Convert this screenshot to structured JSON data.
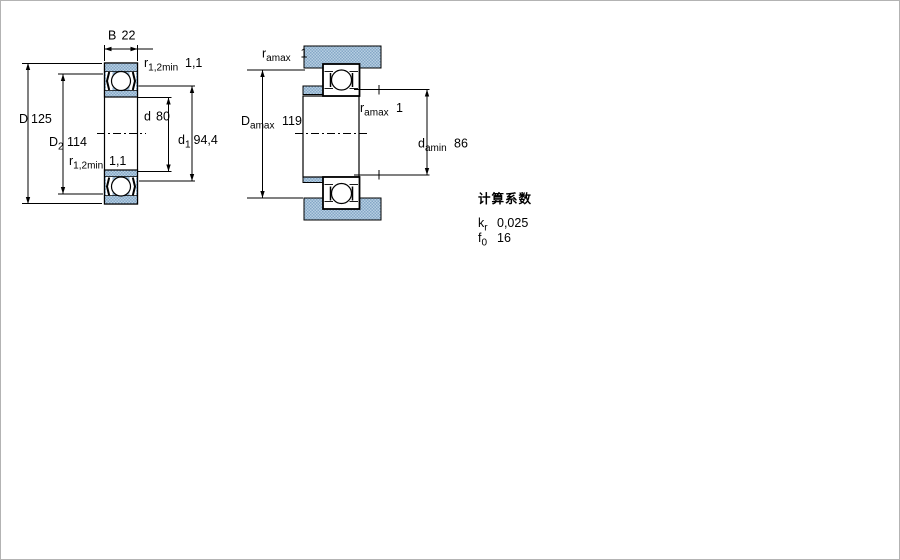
{
  "colors": {
    "line": "#000000",
    "hatch_light": "#b7cfe3",
    "hatch_dark": "#85a7c6",
    "background": "#ffffff",
    "frame": "#b3b3b3"
  },
  "figure1": {
    "description": "bearing cross-section with shields",
    "dims": {
      "B": {
        "symbol": "B",
        "subscript": "",
        "value": "22"
      },
      "r12_top": {
        "symbol": "r",
        "subscript": "1,2min",
        "value": "1,1"
      },
      "D": {
        "symbol": "D",
        "subscript": "",
        "value": "125"
      },
      "D2": {
        "symbol": "D",
        "subscript": "2",
        "value": "114"
      },
      "r12_bottom": {
        "symbol": "r",
        "subscript": "1,2min",
        "value": "1,1"
      },
      "d": {
        "symbol": "d",
        "subscript": "",
        "value": "80"
      },
      "d1": {
        "symbol": "d",
        "subscript": "1",
        "value": "94,4"
      }
    }
  },
  "figure2": {
    "description": "mounted bearing abutment dimensions",
    "dims": {
      "ra_top": {
        "symbol": "r",
        "subscript": "amax",
        "value": "1"
      },
      "Da": {
        "symbol": "D",
        "subscript": "amax",
        "value": "119"
      },
      "ra_mid": {
        "symbol": "r",
        "subscript": "amax",
        "value": "1"
      },
      "da": {
        "symbol": "d",
        "subscript": "amin",
        "value": "86"
      }
    }
  },
  "calculation_factors": {
    "title": "计算系数",
    "rows": [
      {
        "symbol": "k",
        "subscript": "r",
        "value": "0,025"
      },
      {
        "symbol": "f",
        "subscript": "0",
        "value": "16"
      }
    ]
  }
}
